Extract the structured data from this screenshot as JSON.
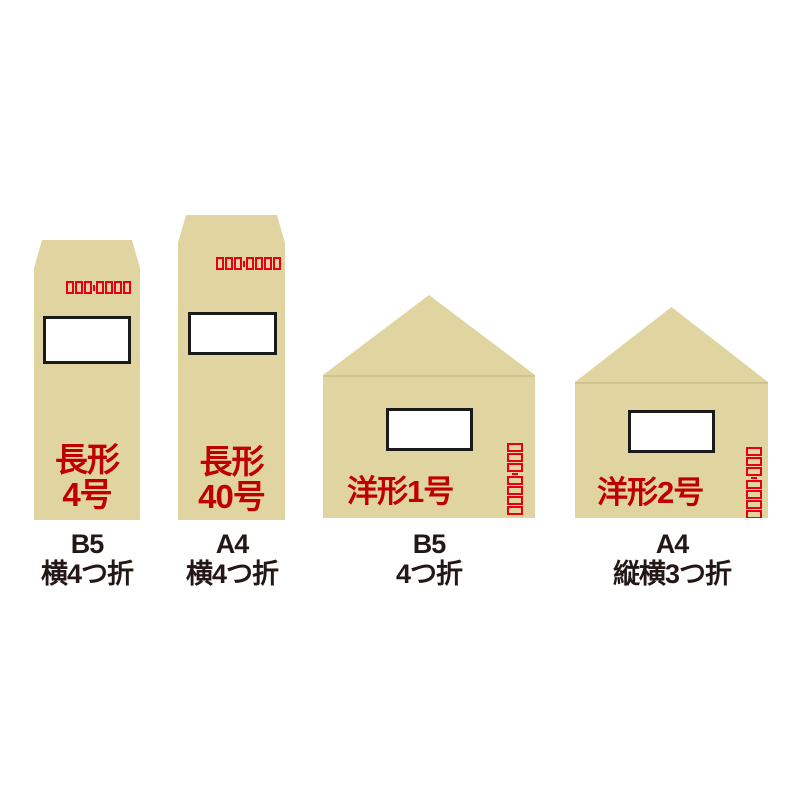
{
  "colors": {
    "envelope_beige": "#e0d5a0",
    "label_red": "#c00000",
    "zip_red": "#e60012",
    "text_black": "#231815",
    "window_border": "#1a1a1a",
    "background": "#ffffff"
  },
  "zip": {
    "box_count": 7,
    "group_split": 3
  },
  "envelopes": [
    {
      "id": "nagagata-4",
      "shape": "tall",
      "label_lines": [
        "長形",
        "4号"
      ],
      "caption_lines": [
        "B5",
        "横4つ折"
      ]
    },
    {
      "id": "nagagata-40",
      "shape": "tall",
      "label_lines": [
        "長形",
        "40号"
      ],
      "caption_lines": [
        "A4",
        "横4つ折"
      ]
    },
    {
      "id": "yogata-1",
      "shape": "wide-flap",
      "label_lines": [
        "洋形1号"
      ],
      "caption_lines": [
        "B5",
        "4つ折"
      ]
    },
    {
      "id": "yogata-2",
      "shape": "wide-flap",
      "label_lines": [
        "洋形2号"
      ],
      "caption_lines": [
        "A4",
        "縦横3つ折"
      ]
    }
  ]
}
